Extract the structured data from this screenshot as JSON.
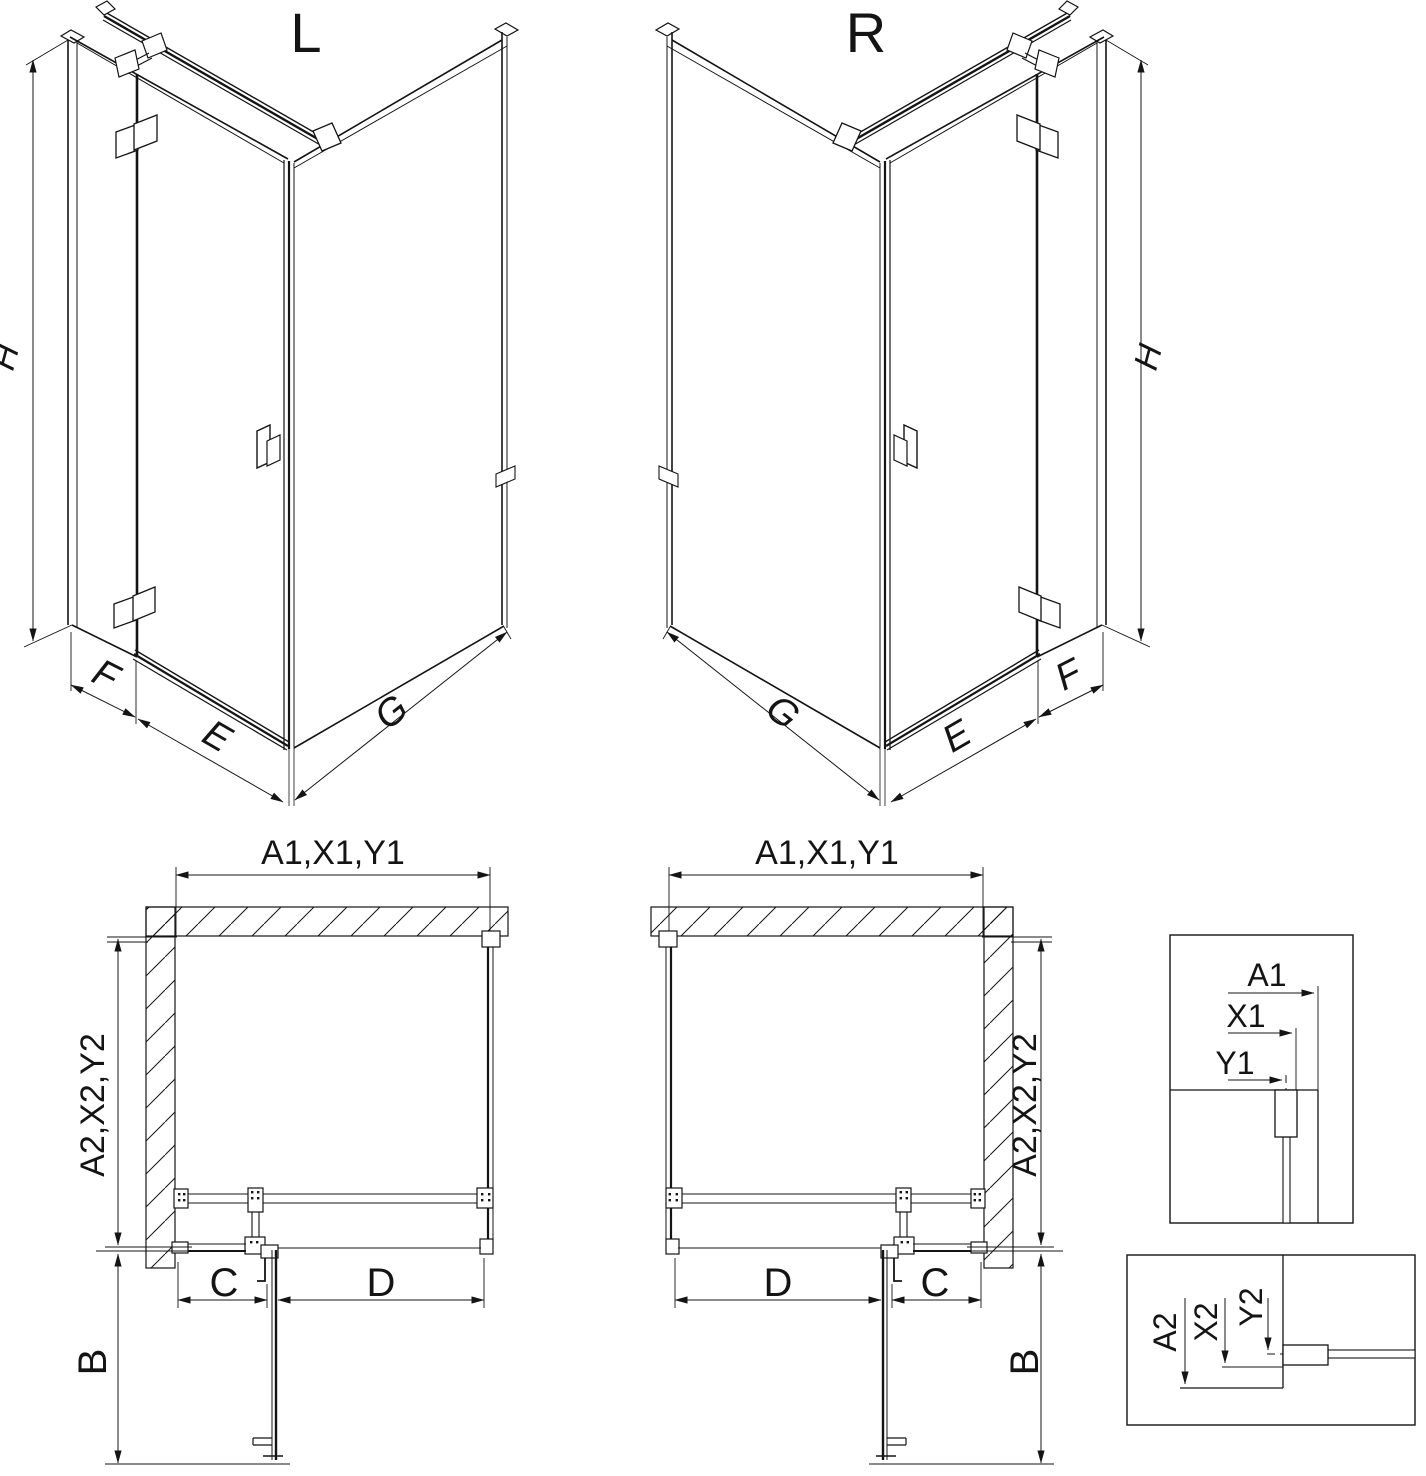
{
  "views": {
    "iso_left": {
      "variant_label": "L",
      "height_dim": "H",
      "fixed_panel_dim": "F",
      "door_dim": "E",
      "side_panel_dim": "G"
    },
    "iso_right": {
      "variant_label": "R",
      "height_dim": "H",
      "fixed_panel_dim": "F",
      "door_dim": "E",
      "side_panel_dim": "G"
    },
    "plan_left": {
      "width_dim": "A1,X1,Y1",
      "depth_dim": "A2,X2,Y2",
      "fixed_width_dim": "C",
      "door_width_dim": "D",
      "door_swing_dim": "B"
    },
    "plan_right": {
      "width_dim": "A1,X1,Y1",
      "depth_dim": "A2,X2,Y2",
      "fixed_width_dim": "C",
      "door_width_dim": "D",
      "door_swing_dim": "B"
    },
    "detail_width": {
      "outer_dim": "A1",
      "profile_dim": "X1",
      "glass_dim": "Y1"
    },
    "detail_depth": {
      "outer_dim": "A2",
      "profile_dim": "X2",
      "glass_dim": "Y2"
    }
  },
  "colors": {
    "line": "#141414",
    "background": "#ffffff"
  }
}
